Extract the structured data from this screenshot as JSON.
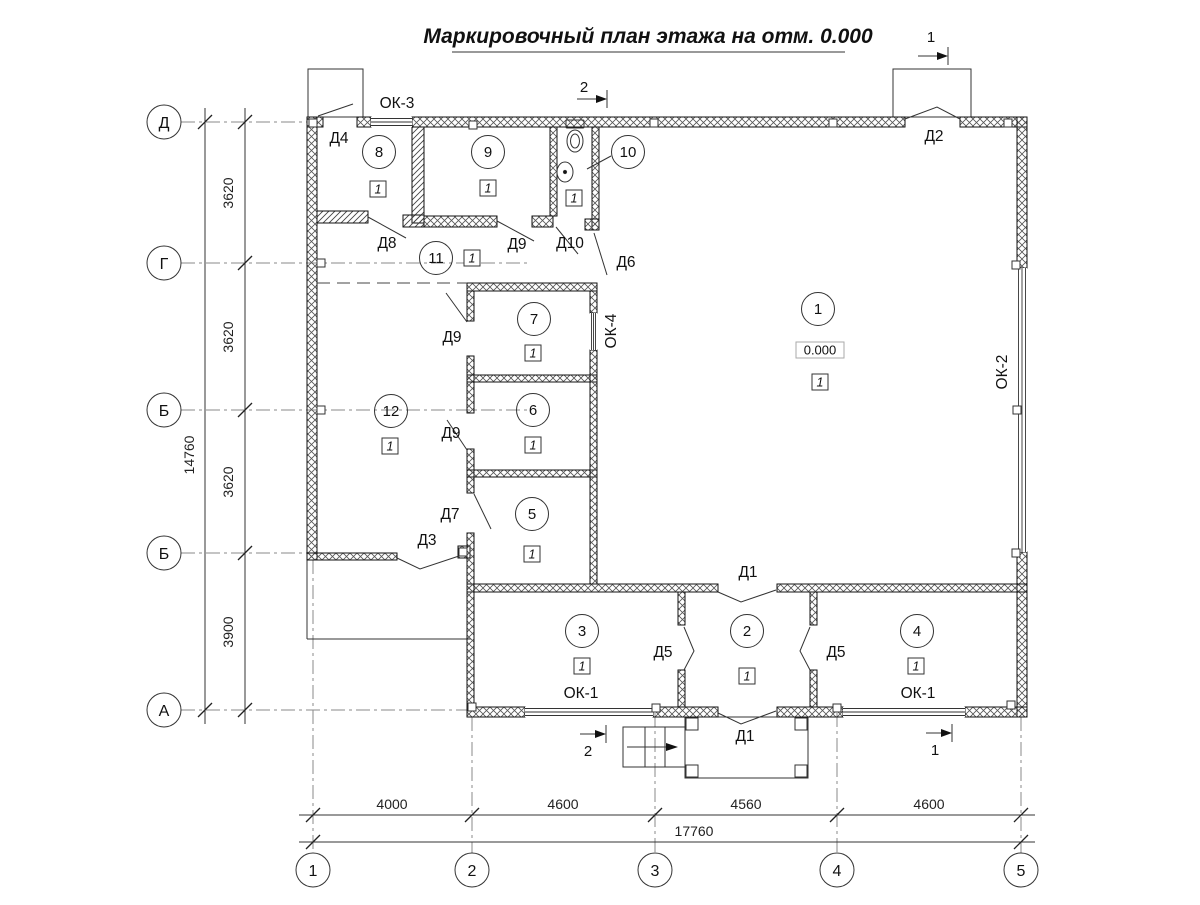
{
  "title": "Маркировочный план этажа на отм. 0.000",
  "axes": {
    "left": [
      "Д",
      "Г",
      "Б",
      "Б",
      "А"
    ],
    "bottom": [
      "1",
      "2",
      "3",
      "4",
      "5"
    ]
  },
  "dimensions": {
    "left_segments": [
      "3620",
      "3620",
      "3620",
      "3900"
    ],
    "left_total": "14760",
    "bottom_segments": [
      "4000",
      "4600",
      "4560",
      "4600"
    ],
    "bottom_total": "17760"
  },
  "rooms": [
    "1",
    "2",
    "3",
    "4",
    "5",
    "6",
    "7",
    "8",
    "9",
    "10",
    "11",
    "12"
  ],
  "marks": {
    "finish": "1",
    "elevation": "0.000"
  },
  "doors": {
    "d1": "Д1",
    "d2": "Д2",
    "d3": "Д3",
    "d4": "Д4",
    "d5": "Д5",
    "d6": "Д6",
    "d7": "Д7",
    "d8": "Д8",
    "d9": "Д9",
    "d10": "Д10"
  },
  "windows": {
    "ok1": "ОК-1",
    "ok2": "ОК-2",
    "ok3": "ОК-3",
    "ok4": "ОК-4"
  },
  "sections": {
    "s1": "1",
    "s2": "2"
  }
}
